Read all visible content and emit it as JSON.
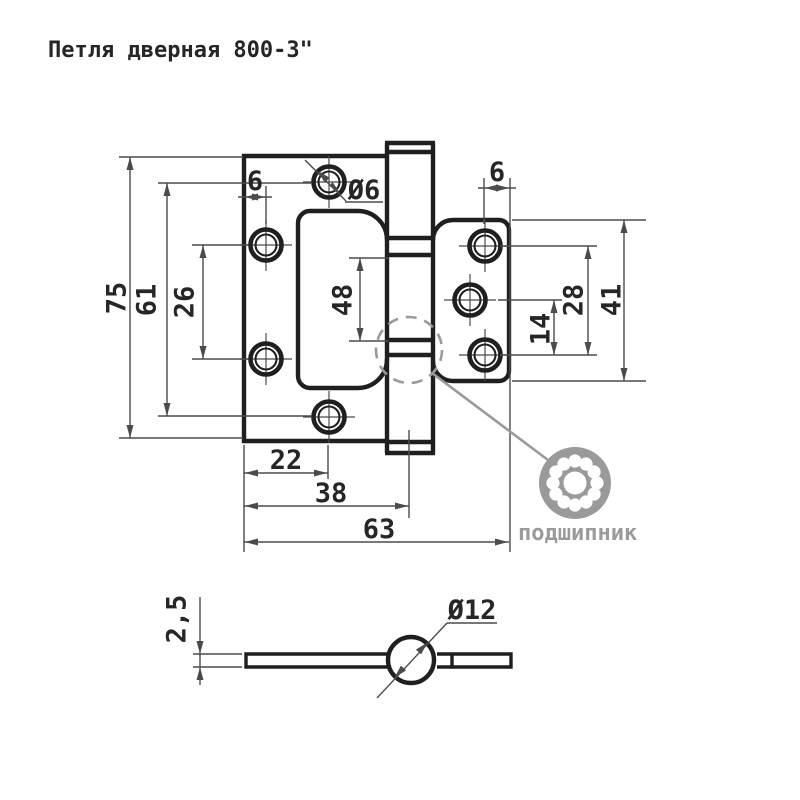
{
  "title": "Петля  дверная 800-3\"",
  "colors": {
    "outline": "#1f1f1f",
    "thin_line": "#4b4b4b",
    "gray_accent": "#9a9a9a",
    "background": "#ffffff"
  },
  "views": {
    "front": {
      "dims": {
        "overall_height": "75",
        "outer_hole_span": "61",
        "left_hole_span": "26",
        "left_edge_offset": "6",
        "screw_hole_dia": "Ø6",
        "knuckle_length": "48",
        "right_edge_offset": "6",
        "right_lower_hole_span": "14",
        "right_hole_span": "28",
        "right_leaf_height": "41",
        "hole_column_offset": "22",
        "left_leaf_width": "38",
        "overall_width": "63"
      },
      "callout_label": "подшипник"
    },
    "section": {
      "dims": {
        "leaf_thickness": "2,5",
        "barrel_dia": "Ø12"
      }
    }
  }
}
